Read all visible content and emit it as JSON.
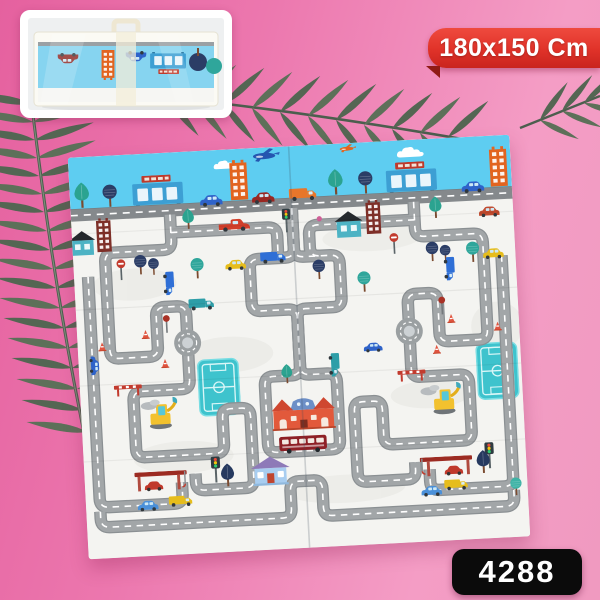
{
  "labels": {
    "size": "180x150 Cm",
    "sku": "4288"
  },
  "colors": {
    "background_pink": "#ee79b0",
    "ribbon_red": "#e03229",
    "badge_black": "#0b0b0b",
    "leaf_green": "#546653",
    "mat_sky_blue": "#5ecdf1",
    "mat_ground_white": "#f4f4f1",
    "road_gray": "#9ba0a2",
    "field_teal": "#3ec3cd"
  },
  "scene": {
    "type": "product-photo",
    "subject": "foldable baby play mat printed with a city road map",
    "inset": "folded play mat packed in a clear carry bag with handle",
    "motifs": [
      "roads",
      "roundabouts",
      "soccer-fields",
      "houses",
      "cars",
      "trucks",
      "bus",
      "trees",
      "gas-stations",
      "excavators",
      "traffic-lights",
      "stop-signs",
      "cones",
      "airplanes",
      "clouds"
    ]
  }
}
